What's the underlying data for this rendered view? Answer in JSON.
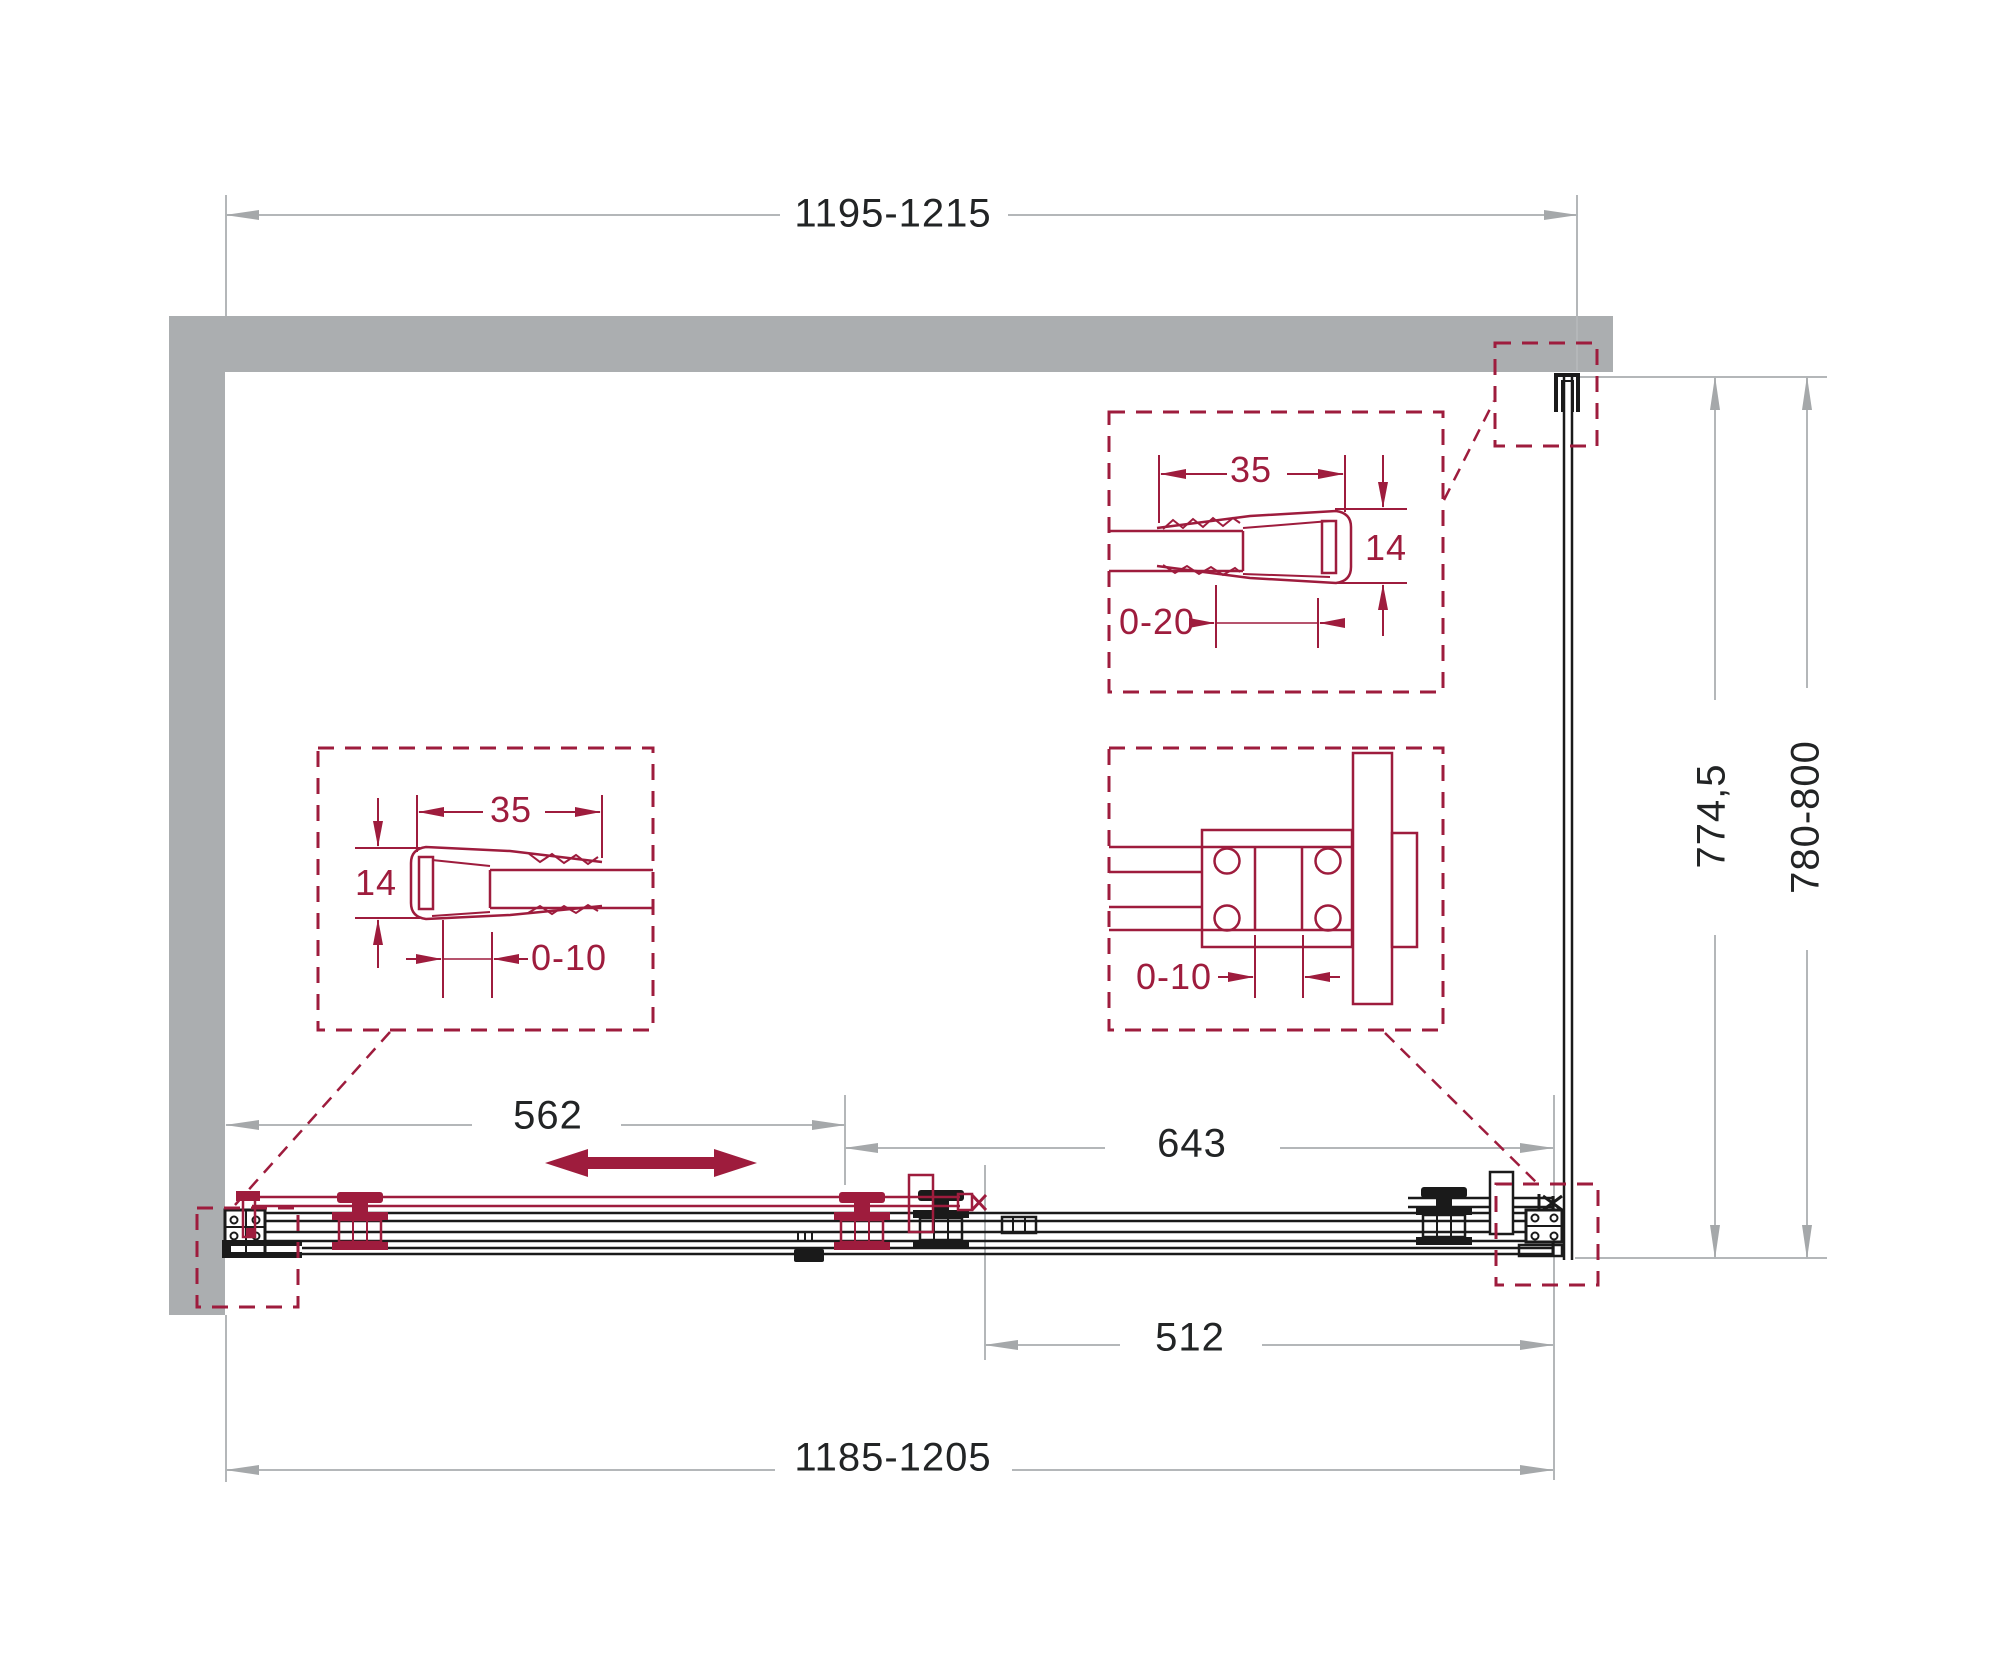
{
  "drawing": {
    "title": "shower-enclosure-plan-view",
    "dimensions": {
      "overall_width_top": "1195-1215",
      "overall_width_bottom": "1185-1205",
      "door_section_width": "562",
      "fixed_section_width": "643",
      "opening_width": "512",
      "side_glass_depth": "774,5",
      "side_overall_depth": "780-800"
    },
    "detail_left_profile": {
      "width": "35",
      "height": "14",
      "adjust_range": "0-10"
    },
    "detail_top_right_profile": {
      "width": "35",
      "height": "14",
      "adjust_range": "0-20"
    },
    "detail_connector_bracket": {
      "adjust_range": "0-10"
    },
    "icons": {
      "slide_direction": "double-horizontal-arrow"
    },
    "colors": {
      "accent_maroon": "#9e1c3d",
      "wall_gray": "#abaeb0",
      "dim_line_gray": "#b4b7b9",
      "ink_black": "#1a1a1a"
    }
  }
}
